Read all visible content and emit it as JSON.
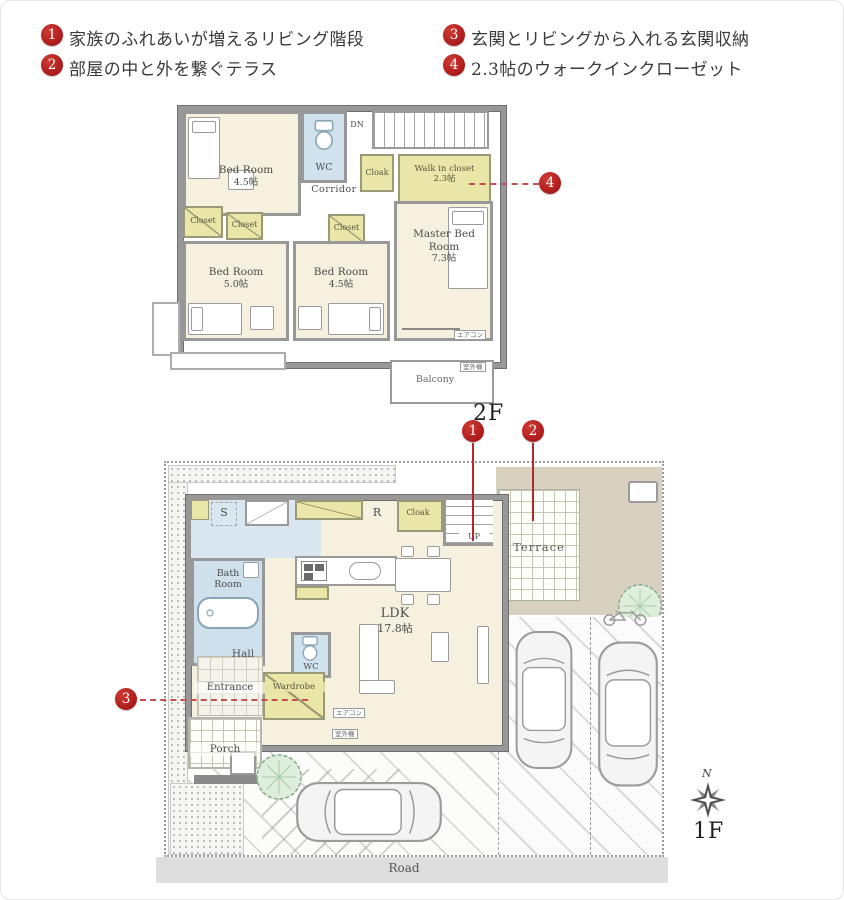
{
  "colors": {
    "accent_red": "#a50d12",
    "floor_cream": "#f6f1de",
    "closet_yellow": "#eae6a8",
    "wet_blue": "#cfe2ee",
    "wall_gray": "#989898",
    "ground_tan": "#d8d1c0"
  },
  "header": {
    "features": [
      {
        "num": "1",
        "text": "家族のふれあいが増えるリビング階段"
      },
      {
        "num": "2",
        "text": "部屋の中と外を繋ぐテラス"
      },
      {
        "num": "3",
        "text": "玄関とリビングから入れる玄関収納"
      },
      {
        "num": "4",
        "text": "2.3帖のウォークインクローゼット"
      }
    ]
  },
  "floor2": {
    "floor_label": "2F",
    "badge": "4",
    "bedroom_nw_name": "Bed Room",
    "bedroom_nw_size": "4.5帖",
    "wc": "WC",
    "dn": "DN",
    "cloak": "Cloak",
    "wic_name": "Walk in closet",
    "wic_size": "2.3帖",
    "corridor": "Corridor",
    "closet_a": "Closet",
    "closet_b": "Closet",
    "closet_c": "Closet",
    "bedroom_sw_name": "Bed Room",
    "bedroom_sw_size": "5.0帖",
    "bedroom_s_name": "Bed Room",
    "bedroom_s_size": "4.5帖",
    "master_name": "Master Bed Room",
    "master_size": "7.3帖",
    "balcony": "Balcony",
    "aircon": "エアコン",
    "outdoor_unit": "室外機"
  },
  "floor1": {
    "floor_label": "1F",
    "badge_living_stairs": "1",
    "badge_terrace": "2",
    "badge_wardrobe": "3",
    "compass_north": "N",
    "s_room": "S",
    "refrigerator": "R",
    "cloak": "Cloak",
    "up": "UP",
    "terrace": "Terrace",
    "bathroom": "Bath Room",
    "hall": "Hall",
    "wc": "WC",
    "entrance": "Entrance",
    "wardrobe": "Wardrobe",
    "ldk_name": "LDK",
    "ldk_size": "17.8帖",
    "porch": "Porch",
    "road": "Road",
    "aircon": "エアコン",
    "outdoor_unit": "室外機"
  }
}
